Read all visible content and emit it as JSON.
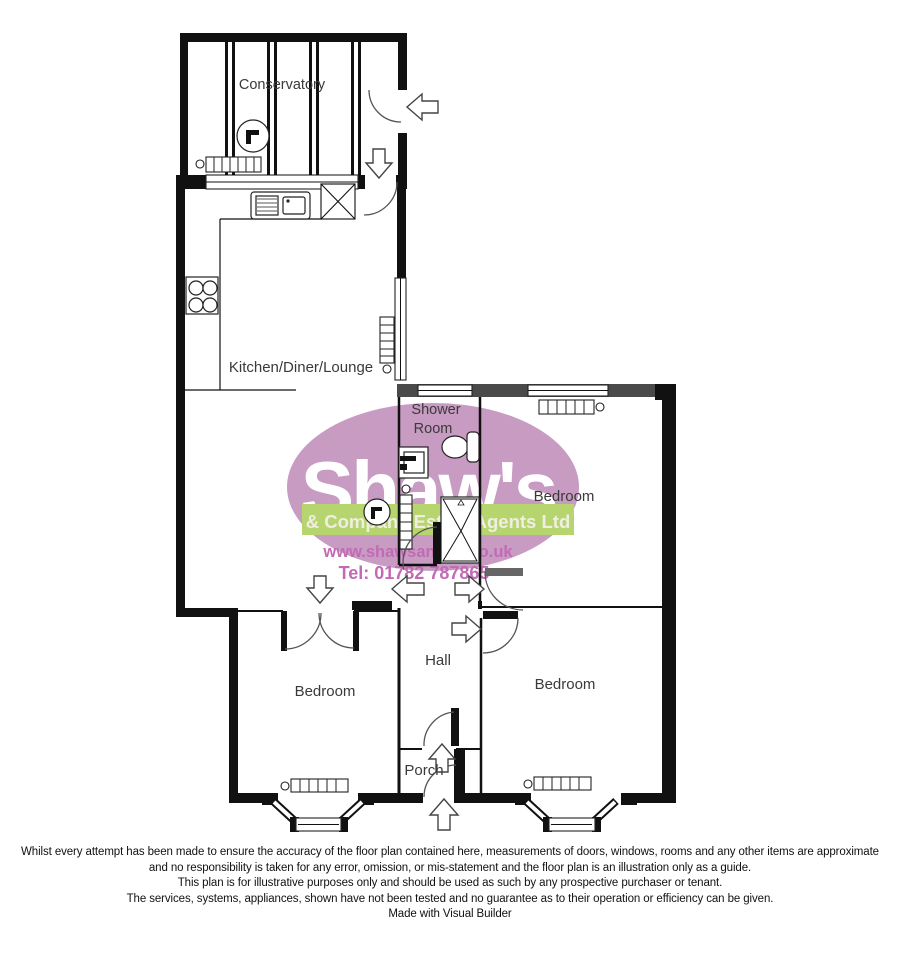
{
  "rooms": {
    "conservatory": "Conservatory",
    "kitchen": "Kitchen/Diner/Lounge",
    "shower_line1": "Shower",
    "shower_line2": "Room",
    "bedroom_right_top": "Bedroom",
    "bedroom_left": "Bedroom",
    "bedroom_right_bottom": "Bedroom",
    "hall": "Hall",
    "porch": "Porch"
  },
  "logo": {
    "name": "Shaw's",
    "tagline": "& Company Estate Agents Ltd",
    "website": "www.shawsandco.co.uk",
    "phone": "Tel: 01782 787865",
    "colors": {
      "ellipse": "#c79bc2",
      "band": "#b7d56e",
      "name_text": "#ffffff",
      "tagline_text": "#f0eee1",
      "link_text": "#c36ab5"
    }
  },
  "footer": {
    "line1": "Whilst every attempt has been made to ensure the accuracy of the floor plan contained here, measurements of doors, windows, rooms and any other items are approximate",
    "line2": "and no responsibility is taken for any error, omission, or mis-statement and the floor plan is an illustration only as a guide.",
    "line3": "This plan is for illustrative purposes only and should be used as such by any prospective purchaser or tenant.",
    "line4": "The services, systems, appliances, shown have not been tested and no guarantee  as to their operation or efficiency can be given.",
    "line5": "Made with Visual Builder"
  }
}
